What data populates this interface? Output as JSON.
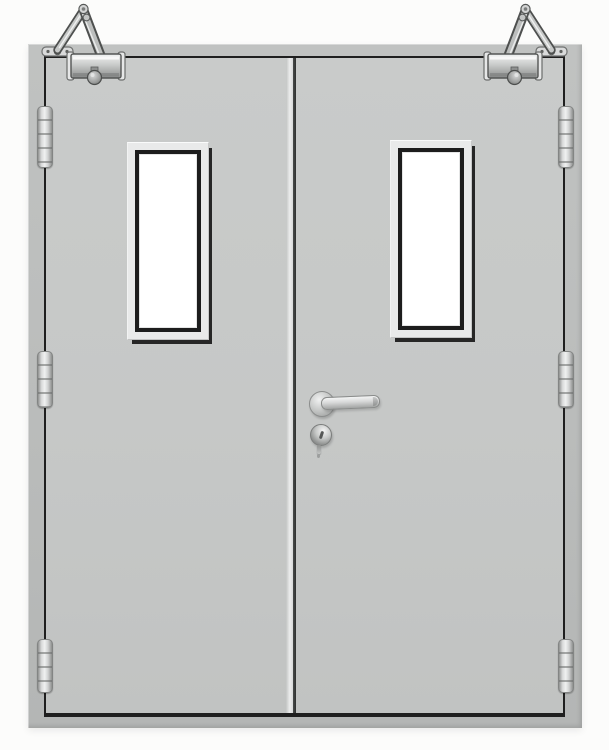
{
  "scene": {
    "label": "Double-leaf steel fire door, gray, closed, front view on white background",
    "leaf_count": 2,
    "hinge_count": 6,
    "closer_count": 2,
    "vision_panel_count": 2
  },
  "colors": {
    "bg": "#fcfcfb",
    "frame": "#bcbebd",
    "leaf": "#c6c8c7",
    "outline": "#1f1f1f",
    "stile_highlight": "#eceded",
    "bezel": "#e9eaea",
    "bezel_shadow": "#262626",
    "glazing": "#1d1d1d",
    "glass": "#ffffff",
    "hw_light": "#f0f1f1",
    "hw_mid": "#c0c2c1",
    "hw_dark": "#6f7170"
  },
  "door": {
    "frame_label": "Steel door frame",
    "left_leaf_label": "Left door leaf",
    "right_leaf_label": "Right door leaf",
    "stile_label": "Meeting stile gap",
    "vision_left_label": "Left leaf vision panel (glazed)",
    "vision_right_label": "Right leaf vision panel (glazed)"
  },
  "hardware": {
    "closer_left_label": "Overhead door closer on left leaf",
    "closer_right_label": "Overhead door closer on right leaf",
    "hinge_label": "Stainless hinge",
    "handle_label": "Lever handle",
    "lock_label": "Lock cylinder with hanging key"
  }
}
